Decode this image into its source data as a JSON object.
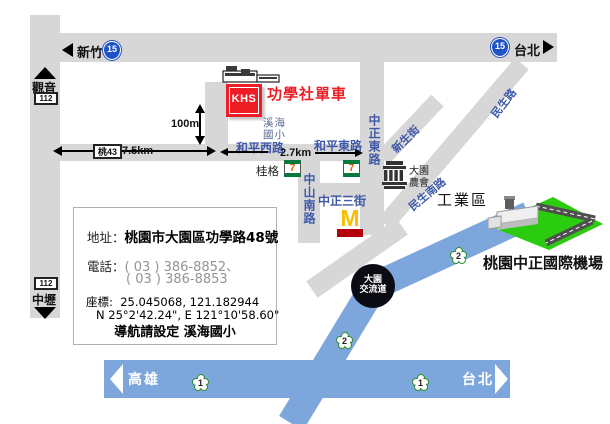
{
  "store": {
    "logo": "KHS",
    "name": "功學社單車"
  },
  "top_highway": {
    "left_dest": "新竹",
    "right_dest": "台北",
    "shield": "15"
  },
  "left_road": {
    "shield": "112",
    "north_dest": "觀音",
    "south_dest": "中壢"
  },
  "distances": {
    "county_route": "桃43",
    "west_leg": "7.5km",
    "east_leg": "2.7km",
    "store_leg": "100m"
  },
  "roads": {
    "heping_w": "和平西路",
    "heping_e": "和平東路",
    "zhongshan_s": "中山南路",
    "zhongzheng_3": "中正三街",
    "zhongzheng_e": "中正東路",
    "xinsheng": "新生街",
    "minsheng": "民生路",
    "minsheng_s": "民生南路"
  },
  "landmarks": {
    "school": [
      "溪海",
      "國小"
    ],
    "quaker": "桂格",
    "seven_eleven": "7",
    "mcdonalds": "M",
    "farmers": [
      "大園",
      "農會"
    ],
    "industrial_zone": "工業區",
    "airport": "桃園中正國際機場"
  },
  "interchange": {
    "name": [
      "大園",
      "交流道"
    ],
    "shield": "2"
  },
  "freeway1": {
    "left_dest": "高雄",
    "right_dest": "台北",
    "shield": "1"
  },
  "info_box": {
    "address_label": "地址：",
    "address": "桃園市大園區功學路48號",
    "phone_label": "電話：",
    "phone1": "( 03 ) 386-8852、",
    "phone2": "( 03 ) 386-8853",
    "coord_label": "座標:",
    "coord_decimal": "25.045068, 121.182944",
    "coord_dms": "N 25°2'42.24\", E 121°10'58.60\"",
    "nav_hint": "導航請設定  溪海國小"
  },
  "colors": {
    "road_gray": "#d7d7d7",
    "freeway_blue": "#7da6dd",
    "airport_green": "#2bcb10",
    "brand_red": "#ee1c25",
    "road_label_blue": "#3f59a8",
    "shield_blue": "#2053c5",
    "seven_green": "#067a3c",
    "seven_orange": "#e55b00",
    "mcd_yellow": "#f7bf00",
    "mcd_red": "#b3000c"
  }
}
